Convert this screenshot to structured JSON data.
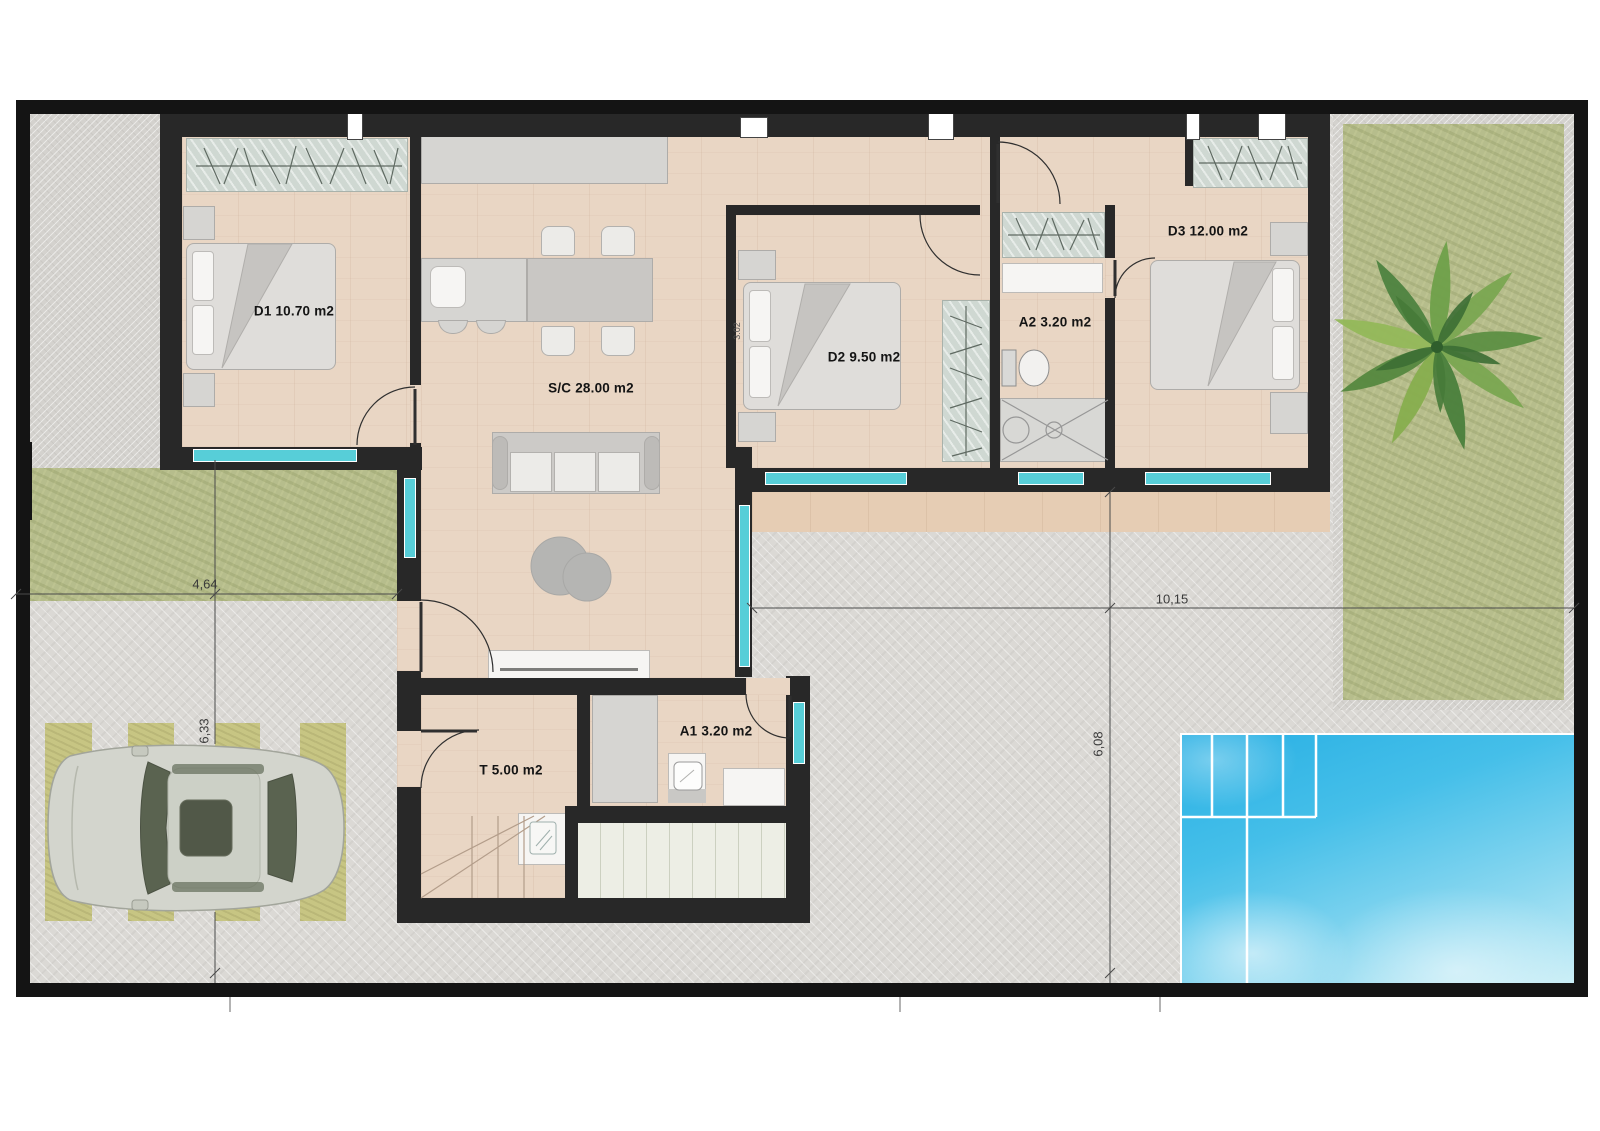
{
  "plan": {
    "rooms": [
      {
        "id": "d1",
        "label": "D1 10.70 m2"
      },
      {
        "id": "sc",
        "label": "S/C 28.00 m2"
      },
      {
        "id": "d2",
        "label": "D2 9.50 m2"
      },
      {
        "id": "a2",
        "label": "A2 3.20 m2"
      },
      {
        "id": "d3",
        "label": "D3 12.00 m2"
      },
      {
        "id": "a1",
        "label": "A1 3.20 m2"
      },
      {
        "id": "t",
        "label": "T 5.00 m2"
      }
    ],
    "dimensions": {
      "plot_front_width": "4,64",
      "plot_left_depth": "6,33",
      "plot_right_width": "10,15",
      "plot_right_depth": "6,08",
      "bedroom2_depth": "3.02"
    },
    "colors": {
      "wall": "#282828",
      "window": "#57ced8",
      "pool_water": "#35b7e6",
      "grass": "#b6bd8c",
      "wood_floor": "#e9d6c4",
      "concrete": "#dbd9d5",
      "deck": "#edeee5"
    }
  }
}
